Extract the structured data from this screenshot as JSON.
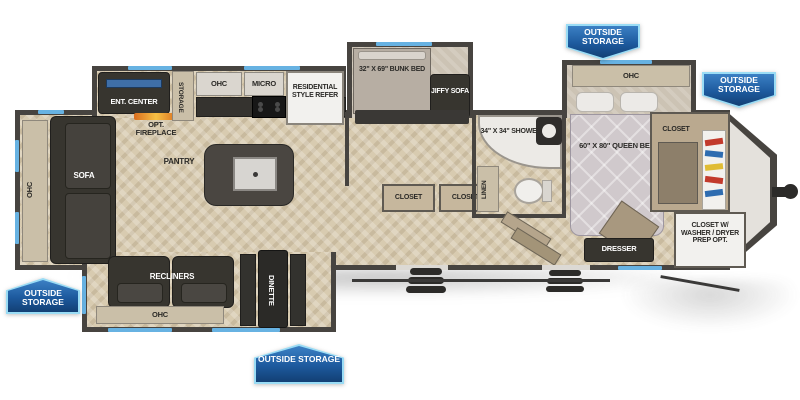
{
  "title": "Travel trailer floor plan",
  "badges": [
    {
      "label": "OUTSIDE STORAGE"
    },
    {
      "label": "OUTSIDE STORAGE"
    },
    {
      "label": "OUTSIDE STORAGE"
    },
    {
      "label": "OUTSIDE STORAGE"
    }
  ],
  "rear_living": {
    "ohc": "OHC",
    "sofa": "SOFA",
    "ent_center": "ENT. CENTER",
    "opt_fireplace": "OPT. FIREPLACE",
    "storage": "STORAGE",
    "recliners": "RECLINERS",
    "dinette": "DINETTE",
    "ohc_lower": "OHC"
  },
  "kitchen": {
    "ohc": "OHC",
    "micro": "MICRO",
    "refer": "RESIDENTIAL STYLE REFER",
    "pantry": "PANTRY"
  },
  "bunk_room": {
    "bunk_bed": "32\" X 69\" BUNK BED",
    "jiffy_sofa": "JIFFY SOFA",
    "closet_left": "CLOSET",
    "closet_right": "CLOSET"
  },
  "bathroom": {
    "shower": "34\" X 34\" SHOWER",
    "linen": "LINEN"
  },
  "bedroom": {
    "ohc": "OHC",
    "queen_bed": "60\" X 80\" QUEEN BED",
    "closet": "CLOSET",
    "dresser": "DRESSER",
    "closet_washer_dryer": "CLOSET W/ WASHER / DRYER PREP OPT."
  },
  "colors": {
    "wall": "#474440",
    "floor": "#d8cbb0",
    "badge_blue": "#1d5a9e",
    "badge_border": "#9adcf5",
    "window_accent": "#67b2e2",
    "flame_orange": "#e08a28"
  }
}
